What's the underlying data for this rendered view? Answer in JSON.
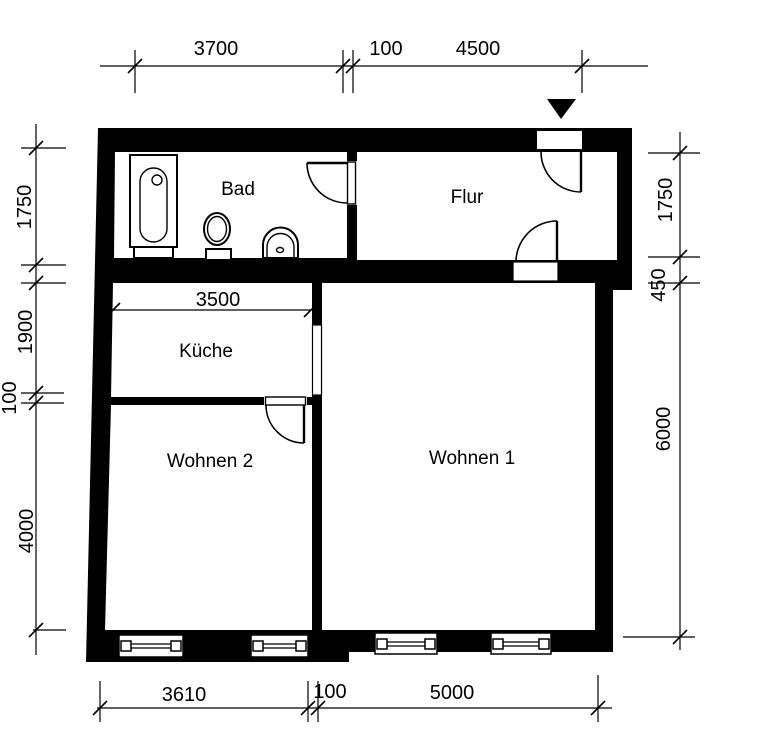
{
  "rooms": [
    {
      "name": "Bad"
    },
    {
      "name": "Flur"
    },
    {
      "name": "Küche"
    },
    {
      "name": "Wohnen 2"
    },
    {
      "name": "Wohnen 1"
    }
  ],
  "dimensions": {
    "top": [
      "3700",
      "100",
      "4500"
    ],
    "bottom": [
      "3610",
      "100",
      "5000"
    ],
    "left": [
      "1750",
      "1900",
      "100",
      "4000"
    ],
    "right": [
      "1750",
      "450",
      "6000"
    ],
    "kitchen_width": "3500"
  },
  "icons": {
    "entrance_marker": "filled-triangle-down"
  },
  "colors": {
    "wall": "#000000",
    "background": "#ffffff"
  }
}
